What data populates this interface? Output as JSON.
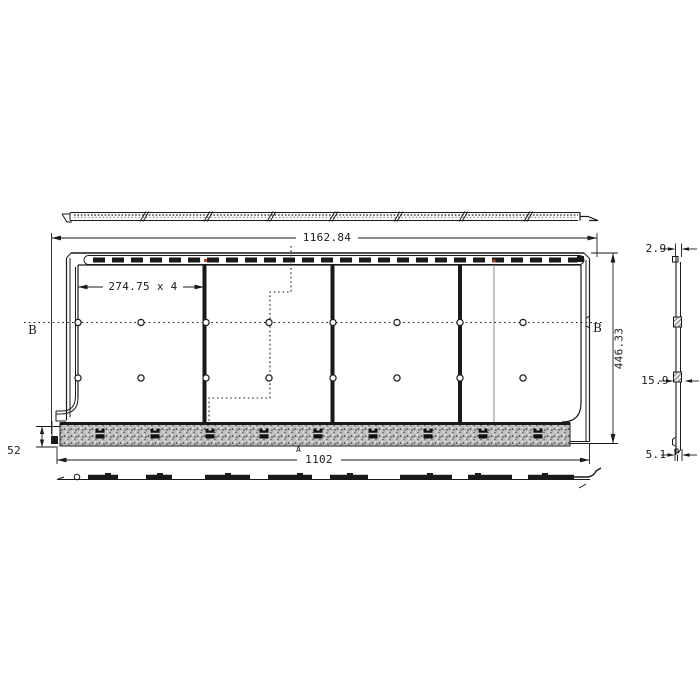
{
  "dims": {
    "overall_width": "1162.84",
    "panel_pitch": "274.75 x 4",
    "overall_height": "446.33",
    "base_width": "1102",
    "base_height": "52",
    "edge_thickness": "2.9",
    "mid_depth": "15.9",
    "bottom_thickness": "5.1"
  },
  "labels": {
    "section_left": "B",
    "section_right": "B",
    "detail_marker": "A"
  },
  "colors": {
    "line": "#1a1a1a",
    "highlight": "#c23b22",
    "hatch_fill": "#bfbfbf"
  }
}
